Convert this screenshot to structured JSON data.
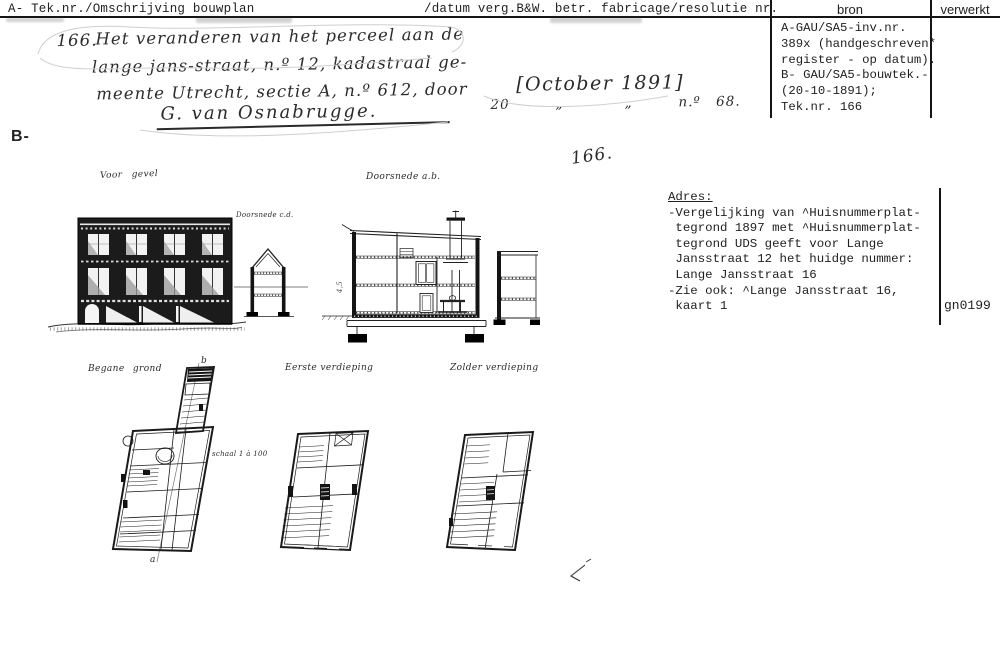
{
  "header": {
    "left_title": "A- Tek.nr./Omschrijving bouwplan",
    "right_title": "/datum verg.B&W. betr. fabricage/resolutie nr.",
    "col_bron": "bron",
    "col_verwerkt": "verwerkt"
  },
  "bron_panel": {
    "lines": [
      "A-GAU/SA5-inv.nr.",
      "389x (handgeschreven*",
      "register - op datum).",
      "B- GAU/SA5-bouwtek.-",
      "(20-10-1891);",
      "Tek.nr. 166"
    ]
  },
  "handwritten": {
    "margin_mark": "B-",
    "item_number": "166.",
    "line1": "Het veranderen van het perceel aan de",
    "line2": "lange jans-straat, n.º 12, kadastraal ge-",
    "line3": "meente Utrecht, sectie A, n.º 612, door",
    "signature": "G. van Osnabrugge.",
    "date_bracket": "[October 1891]",
    "date_line": "20   „    „   n.º 68.",
    "center_number": "166."
  },
  "drawings": {
    "facade_label": "Voor gevel",
    "section_ab_label": "Doorsnede a.b.",
    "section_cd_label": "Doorsnede c.d.",
    "plan_ground_label": "Begane grond",
    "plan_first_label": "Eerste verdieping",
    "plan_attic_label": "Zolder verdieping",
    "scale_note": "schaal 1 à 100",
    "section_dim_note": "4,5",
    "marker_a": "a",
    "marker_b": "b"
  },
  "adres_panel": {
    "heading": "Adres:",
    "lines": [
      "-Vergelijking van ^Huisnummerplat-",
      " tegrond 1897 met ^Huisnummerplat-",
      " tegrond UDS geeft voor Lange",
      " Jansstraat 12 het huidge nummer:",
      " Lange Jansstraat 16",
      "-Zie ook: ^Lange Jansstraat 16,",
      " kaart 1"
    ],
    "code": "gn0199"
  },
  "colors": {
    "ink": "#1a1a1a",
    "paper": "#ffffff",
    "pencil": "#cfcfcf"
  }
}
